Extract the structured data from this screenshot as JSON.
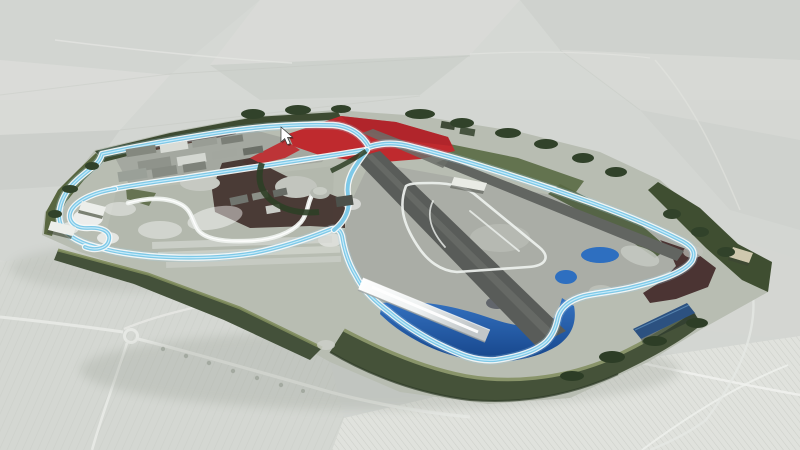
{
  "scene": {
    "type": "3d-aerial-render",
    "subject": "motor-racing-circuit-masterplan",
    "view": "oblique-birds-eye",
    "cursor": {
      "x": 281,
      "y": 127,
      "shape": "arrow-pointer"
    }
  },
  "palette": {
    "background": "#d3d6d2",
    "field_light": "#d8dad6",
    "field_dark": "#cccfcb",
    "hedge_line": "#c3c6c0",
    "road_pale": "#e6e8e4",
    "village_base": "#e0e2dd",
    "site_base": "#b8bdb2",
    "apron_grey": "#a6a9a2",
    "paddock_grey": "#9ea29a",
    "infield_grey": "#b2b6ab",
    "runway_dark": "#595c59",
    "runway_mid": "#626561",
    "berm_dark": "#3d4a31",
    "berm_green": "#44513a",
    "berm_olive": "#58663f",
    "olive_edge": "#89946a",
    "tree_green": "#31422a",
    "green_strip": "#5a6a44",
    "red_zone": "#bf2a2e",
    "red_dark": "#a8232a",
    "maroon": "#4b3433",
    "dark_zone": "#44342f",
    "lake_deep": "#16458a",
    "lake_blue": "#3573c2",
    "pond_blue": "#2e6fc0",
    "track_edge": "#f4f8f8",
    "track_blue": "#7ec9e8",
    "track_glow": "#9fd4ec",
    "track_hi": "#d6f1fb",
    "club_white": "#eef1ee",
    "wing_silver": "#e7eaea",
    "building_white": "#eceeea",
    "building_grey": "#84887f",
    "building_dark": "#4d514b",
    "blue_roof": "#2c5180",
    "beige_stand": "#cfc8ae",
    "shadow_soft": "#969c92",
    "cursor_white": "#ffffff"
  },
  "regions": [
    {
      "id": "countryside-fields",
      "label": "surrounding countryside"
    },
    {
      "id": "circuit-site",
      "label": "circuit grounds"
    },
    {
      "id": "gp-track",
      "label": "grand prix circuit highlighted blue"
    },
    {
      "id": "club-circuits",
      "label": "secondary circuits in white"
    },
    {
      "id": "runways",
      "label": "former airfield runways"
    },
    {
      "id": "pit-paddock",
      "label": "pit and paddock buildings"
    },
    {
      "id": "wing-building",
      "label": "main grandstand building with silver roof"
    },
    {
      "id": "grandstands",
      "label": "white grandstand roofs"
    },
    {
      "id": "berms",
      "label": "landscaped earth banks"
    },
    {
      "id": "lakes",
      "label": "infield lakes and ponds"
    },
    {
      "id": "car-parks",
      "label": "dark red car park areas"
    },
    {
      "id": "red-zones",
      "label": "red development zones"
    },
    {
      "id": "access-roads",
      "label": "access roads and roundabout"
    },
    {
      "id": "village",
      "label": "village and farmland"
    },
    {
      "id": "cursor",
      "label": "mouse pointer"
    }
  ]
}
